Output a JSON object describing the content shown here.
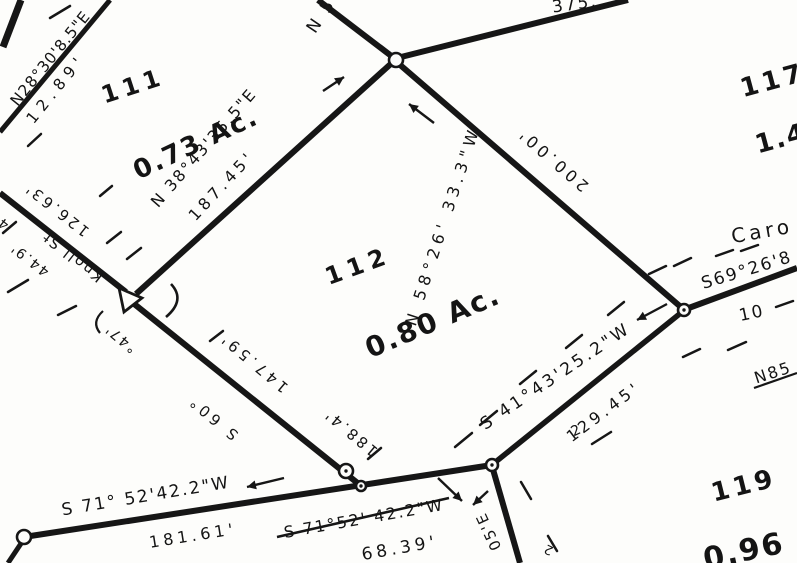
{
  "palette": {
    "paper": "#fdfdfb",
    "ink": "#161616"
  },
  "parcels": [
    {
      "lot": "111",
      "acreage": "0.73 Ac."
    },
    {
      "lot": "112",
      "acreage": "0.80 Ac."
    },
    {
      "lot": "117",
      "acreage": "1.4"
    },
    {
      "lot": "119",
      "acreage": "0.96"
    }
  ],
  "streets": {
    "knoll": "Knoll St.",
    "caro_clipped": "Caro"
  },
  "labels": [
    {
      "name": "bearing-n28",
      "text": "N28°30'8.5\"E",
      "x": 51,
      "y": 59,
      "r": -51,
      "s": 15.5,
      "ls": 1,
      "bold": false
    },
    {
      "name": "dist-12-89",
      "text": "12.89'",
      "x": 57,
      "y": 89,
      "r": -51,
      "s": 15.5,
      "ls": 6,
      "bold": false
    },
    {
      "name": "lot-111",
      "text": "111",
      "x": 133,
      "y": 86,
      "r": -18,
      "s": 24,
      "ls": 5,
      "bold": true
    },
    {
      "name": "lot-111-acreage",
      "text": "0.73 Ac.",
      "x": 196,
      "y": 144,
      "r": -25,
      "s": 26,
      "ls": 2,
      "bold": true
    },
    {
      "name": "bearing-n38",
      "text": "N 38°43'35.5\"E",
      "x": 204,
      "y": 148,
      "r": -49,
      "s": 16,
      "ls": 2,
      "bold": false
    },
    {
      "name": "dist-187-45",
      "text": "187.45'",
      "x": 222,
      "y": 186,
      "r": -47,
      "s": 16,
      "ls": 4,
      "bold": false
    },
    {
      "name": "bearing-n5-fragment",
      "text": "N 5",
      "x": 322,
      "y": 16,
      "r": -56,
      "s": 17,
      "ls": 3,
      "bold": false
    },
    {
      "name": "dist-375-fragment",
      "text": "375.",
      "x": 575,
      "y": 5,
      "r": -8,
      "s": 17,
      "ls": 2,
      "bold": false
    },
    {
      "name": "lot-117",
      "text": "117",
      "x": 773,
      "y": 81,
      "r": -15,
      "s": 26,
      "ls": 4,
      "bold": true
    },
    {
      "name": "lot-117-acreage",
      "text": "1.4",
      "x": 781,
      "y": 139,
      "r": -15,
      "s": 26,
      "ls": 2,
      "bold": true
    },
    {
      "name": "bearing-n58",
      "text": "N 58°26' 33.3\"W",
      "x": 443,
      "y": 226,
      "r": -72,
      "s": 16,
      "ls": 5,
      "bold": false
    },
    {
      "name": "dist-200-00",
      "text": "200.00'",
      "x": 553,
      "y": 159,
      "r": 221,
      "s": 16,
      "ls": 4,
      "bold": false
    },
    {
      "name": "street-caro",
      "text": "Caro",
      "x": 762,
      "y": 231,
      "r": -10,
      "s": 20,
      "ls": 4,
      "bold": false
    },
    {
      "name": "bearing-s69-fragment",
      "text": "S69°26'8",
      "x": 747,
      "y": 271,
      "r": -17,
      "s": 17,
      "ls": 2,
      "bold": false
    },
    {
      "name": "dist-10-fragment",
      "text": "10",
      "x": 752,
      "y": 314,
      "r": -12,
      "s": 17,
      "ls": 2,
      "bold": false
    },
    {
      "name": "bearing-n85-fragment",
      "text": "N85",
      "x": 773,
      "y": 373,
      "r": -18,
      "s": 16,
      "ls": 2,
      "bold": false
    },
    {
      "name": "lot-112",
      "text": "112",
      "x": 358,
      "y": 266,
      "r": -20,
      "s": 24,
      "ls": 6,
      "bold": true
    },
    {
      "name": "lot-112-acreage",
      "text": "0.80 Ac.",
      "x": 433,
      "y": 322,
      "r": -23,
      "s": 28,
      "ls": 2,
      "bold": true
    },
    {
      "name": "dist-126-63",
      "text": "126.63'",
      "x": 57,
      "y": 209,
      "r": 218,
      "s": 15,
      "ls": 3,
      "bold": false
    },
    {
      "name": "street-knoll",
      "text": "Knoll St.",
      "x": 70,
      "y": 254,
      "r": 218,
      "s": 15,
      "ls": 2,
      "bold": false
    },
    {
      "name": "dist-44-9",
      "text": "44.9'",
      "x": 30,
      "y": 259,
      "r": 218,
      "s": 14,
      "ls": 2,
      "bold": false
    },
    {
      "name": "dist-4-edge-fragment",
      "text": "4'",
      "x": 1,
      "y": 221,
      "r": 218,
      "s": 14,
      "ls": 2,
      "bold": false
    },
    {
      "name": "curve-delta-47",
      "text": "°47'",
      "x": 121,
      "y": 338,
      "r": 220,
      "s": 14,
      "ls": 2,
      "bold": false
    },
    {
      "name": "bearing-s60-fragment",
      "text": "S  60°",
      "x": 213,
      "y": 417,
      "r": 220,
      "s": 15,
      "ls": 4,
      "bold": false
    },
    {
      "name": "dist-147-59",
      "text": "147.59'",
      "x": 254,
      "y": 362,
      "r": 220,
      "s": 15,
      "ls": 4,
      "bold": false
    },
    {
      "name": "dist-188-4",
      "text": "188.4'",
      "x": 351,
      "y": 432,
      "r": 220,
      "s": 15,
      "ls": 3,
      "bold": false
    },
    {
      "name": "bearing-s41",
      "text": "S 41°43'25.2\"W",
      "x": 556,
      "y": 377,
      "r": -34,
      "s": 17,
      "ls": 3,
      "bold": false
    },
    {
      "name": "dist-129-45",
      "text": "129.45'",
      "x": 604,
      "y": 412,
      "r": -37,
      "s": 16,
      "ls": 4,
      "bold": false
    },
    {
      "name": "bearing-s71-long",
      "text": "S 71° 52'42.2\"W",
      "x": 146,
      "y": 497,
      "r": -9.5,
      "s": 17,
      "ls": 2,
      "bold": false
    },
    {
      "name": "dist-181-61",
      "text": "181.61'",
      "x": 193,
      "y": 536,
      "r": -9,
      "s": 16,
      "ls": 4,
      "bold": false
    },
    {
      "name": "bearing-s71-short",
      "text": "S 71°52' 42.2\"W",
      "x": 364,
      "y": 519,
      "r": -10,
      "s": 16,
      "ls": 2,
      "bold": false
    },
    {
      "name": "dist-68-39",
      "text": "68.39'",
      "x": 400,
      "y": 549,
      "r": -10,
      "s": 17,
      "ls": 4,
      "bold": false
    },
    {
      "name": "bearing-05e-fragment",
      "text": "05'E",
      "x": 489,
      "y": 531,
      "r": 245,
      "s": 15,
      "ls": 2,
      "bold": false
    },
    {
      "name": "fragment-2-upper",
      "text": "2",
      "x": 576,
      "y": 431,
      "r": -25,
      "s": 14,
      "ls": 0,
      "bold": false
    },
    {
      "name": "fragment-2-lower",
      "text": "2",
      "x": 549,
      "y": 549,
      "r": 205,
      "s": 13,
      "ls": 0,
      "bold": false
    },
    {
      "name": "lot-119",
      "text": "119",
      "x": 744,
      "y": 486,
      "r": -14,
      "s": 26,
      "ls": 4,
      "bold": true
    },
    {
      "name": "lot-119-acreage",
      "text": "0.96",
      "x": 744,
      "y": 552,
      "r": -12,
      "s": 30,
      "ls": 2,
      "bold": true
    }
  ],
  "geometry": {
    "lines": [
      {
        "name": "lotline-n28",
        "x1": 0,
        "y1": 132,
        "x2": 110,
        "y2": 0,
        "w": 5
      },
      {
        "name": "lotline-corner-stub",
        "x1": 21,
        "y1": 0,
        "x2": 3,
        "y2": 47,
        "w": 7
      },
      {
        "name": "knoll-st-line",
        "x1": 0,
        "y1": 193,
        "x2": 126,
        "y2": 292,
        "w": 6
      },
      {
        "name": "lotline-147",
        "x1": 133,
        "y1": 303,
        "x2": 360,
        "y2": 485,
        "w": 6
      },
      {
        "name": "lotline-187",
        "x1": 136,
        "y1": 294,
        "x2": 394,
        "y2": 61,
        "w": 6
      },
      {
        "name": "lotline-nw",
        "x1": 394,
        "y1": 58,
        "x2": 318,
        "y2": 0,
        "w": 6
      },
      {
        "name": "lotline-ne",
        "x1": 401,
        "y1": 57,
        "x2": 628,
        "y2": 0,
        "w": 6
      },
      {
        "name": "lotline-200",
        "x1": 399,
        "y1": 64,
        "x2": 682,
        "y2": 308,
        "w": 6
      },
      {
        "name": "road-line-east",
        "x1": 686,
        "y1": 309,
        "x2": 797,
        "y2": 268,
        "w": 6
      },
      {
        "name": "lotline-s41",
        "x1": 493,
        "y1": 464,
        "x2": 682,
        "y2": 312,
        "w": 5.5
      },
      {
        "name": "road-line-south",
        "x1": 24,
        "y1": 537,
        "x2": 492,
        "y2": 465,
        "w": 6
      },
      {
        "name": "lotline-sw-drop",
        "x1": 24,
        "y1": 539,
        "x2": 8,
        "y2": 563,
        "w": 5
      },
      {
        "name": "road-line-se",
        "x1": 492,
        "y1": 466,
        "x2": 520,
        "y2": 563,
        "w": 6
      },
      {
        "name": "s71-label-underline",
        "x1": 277,
        "y1": 537,
        "x2": 449,
        "y2": 498,
        "w": 2.5
      },
      {
        "name": "n85-underline",
        "x1": 754,
        "y1": 388,
        "x2": 797,
        "y2": 373,
        "w": 2.2
      }
    ],
    "dashes": [
      [
        50,
        18,
        70,
        6
      ],
      [
        28,
        146,
        41,
        134
      ],
      [
        3,
        233,
        16,
        222
      ],
      [
        100,
        196,
        112,
        186
      ],
      [
        107,
        243,
        121,
        232
      ],
      [
        127,
        259,
        141,
        248
      ],
      [
        8,
        292,
        28,
        280
      ],
      [
        58,
        315,
        76,
        306
      ],
      [
        210,
        341,
        223,
        331
      ],
      [
        368,
        459,
        381,
        448
      ],
      [
        455,
        447,
        472,
        433
      ],
      [
        480,
        425,
        497,
        411
      ],
      [
        520,
        384,
        536,
        371
      ],
      [
        566,
        348,
        582,
        335
      ],
      [
        608,
        315,
        624,
        302
      ],
      [
        649,
        274,
        666,
        266
      ],
      [
        674,
        266,
        691,
        258
      ],
      [
        716,
        256,
        733,
        250
      ],
      [
        741,
        251,
        758,
        245
      ],
      [
        683,
        357,
        700,
        349
      ],
      [
        728,
        350,
        746,
        342
      ],
      [
        521,
        482,
        531,
        499
      ],
      [
        548,
        536,
        557,
        551
      ],
      [
        592,
        444,
        611,
        432
      ],
      [
        776,
        307,
        793,
        301
      ]
    ],
    "nodes": [
      {
        "x": 396,
        "y": 60,
        "r": 7,
        "dot": false
      },
      {
        "x": 684,
        "y": 310,
        "r": 6,
        "dot": true
      },
      {
        "x": 346,
        "y": 471,
        "r": 7,
        "dot": true
      },
      {
        "x": 361,
        "y": 486,
        "r": 5,
        "dot": true
      },
      {
        "x": 492,
        "y": 465,
        "r": 6,
        "dot": true
      },
      {
        "x": 24,
        "y": 537,
        "r": 7,
        "dot": false
      }
    ],
    "triangle": {
      "points": "119,288 142,298 124,312"
    },
    "arcs": [
      {
        "name": "curve-tick-right",
        "d": "M 171 284 Q 186 300 166 317",
        "w": 2.6
      },
      {
        "name": "curve-tick-left",
        "d": "M 103 311 Q 91 322 100 333",
        "w": 2.2
      }
    ],
    "arrows": [
      {
        "name": "arrow-n38-ne",
        "x1": 323,
        "y1": 91,
        "x2": 344,
        "y2": 77
      },
      {
        "name": "arrow-n58-nw",
        "x1": 434,
        "y1": 123,
        "x2": 409,
        "y2": 104
      },
      {
        "name": "arrow-s41-sw",
        "x1": 667,
        "y1": 304,
        "x2": 637,
        "y2": 320
      },
      {
        "name": "arrow-s71-sw",
        "x1": 284,
        "y1": 478,
        "x2": 247,
        "y2": 487
      },
      {
        "name": "arrow-s71b-se",
        "x1": 438,
        "y1": 478,
        "x2": 462,
        "y2": 501
      },
      {
        "name": "arrow-s71b-sw",
        "x1": 488,
        "y1": 491,
        "x2": 473,
        "y2": 505
      }
    ]
  }
}
